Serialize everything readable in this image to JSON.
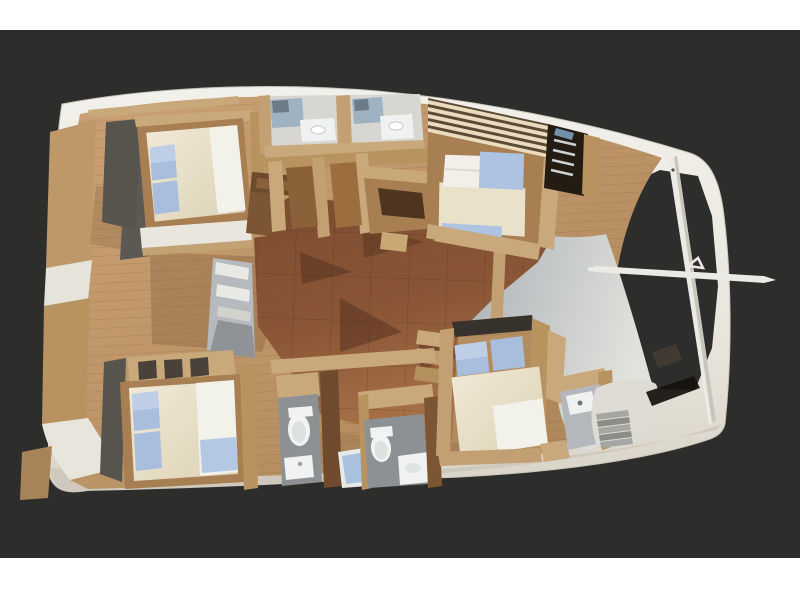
{
  "scene": {
    "description": "3D top-down cutaway rendering of a sailing catamaran interior layout, bow pointing right, on a dark charcoal backdrop with white top and bottom margins",
    "canvas": {
      "width": 800,
      "height": 600
    },
    "visible_features": {
      "double_beds": 4,
      "toilets": 2,
      "shower_glass_stalls": 2,
      "sinks": 5,
      "staircases": 3,
      "ladders": 1,
      "bowsprit_pole": 1,
      "forward_crossbeam": 1
    },
    "regions": [
      "aft-teak-cockpit-deck",
      "central-saloon-dark-floor",
      "upper-aft-cabin-bed",
      "upper-forward-cabin-bed",
      "lower-aft-cabin-bed",
      "lower-forward-cabin-bed",
      "upper-bathrooms-with-glass-showers",
      "lower-bathrooms-with-toilets",
      "nav-desk",
      "galley-island",
      "companionway-ladder",
      "bow-cockpit-stairs",
      "stern-steps"
    ]
  },
  "palette": {
    "frame": "#ffffff",
    "backdrop": "#2d2d2c",
    "hull_light": "#f1efe9",
    "hull_dark": "#dcd7cb",
    "hull_band": "#cfc9bd",
    "teak_light": "#cba176",
    "teak_dark": "#a98256",
    "saloon_light": "#a9744a",
    "saloon_dark": "#7c4c30",
    "corridor_light": "#e2e2dd",
    "corridor_dark": "#aab0b6",
    "wood_wall": "#c9a97c",
    "wood_mid": "#b8935f",
    "wood_dark": "#a87f52",
    "walnut": "#6e4a2d",
    "cabin_floor_shadow": "#57544e",
    "mattress": "#ece4cf",
    "duvet": "#f2f1ea",
    "pillow_blue": "#a9bedd",
    "blanket_blue": "#aec3e2",
    "bath_floor": "#8e9194",
    "fixture": "#f0f2f1",
    "glass": "#9fb2c1",
    "mirror": "#6b7b88",
    "shower_mat": "#a9c2de",
    "ladder_dark": "#241b12",
    "hatch_dark": "#37322c",
    "windshield": "#15120e",
    "stair_light": "#a6a6a2",
    "stair_dark": "#8c8c88",
    "steps_white": "#e8e8e4",
    "steps_gray": "#b6b9bd",
    "pole": "#eceae4",
    "louver_cream": "#e9ddbe",
    "louver_base": "#5d4a36",
    "shadow": "#53301d"
  }
}
